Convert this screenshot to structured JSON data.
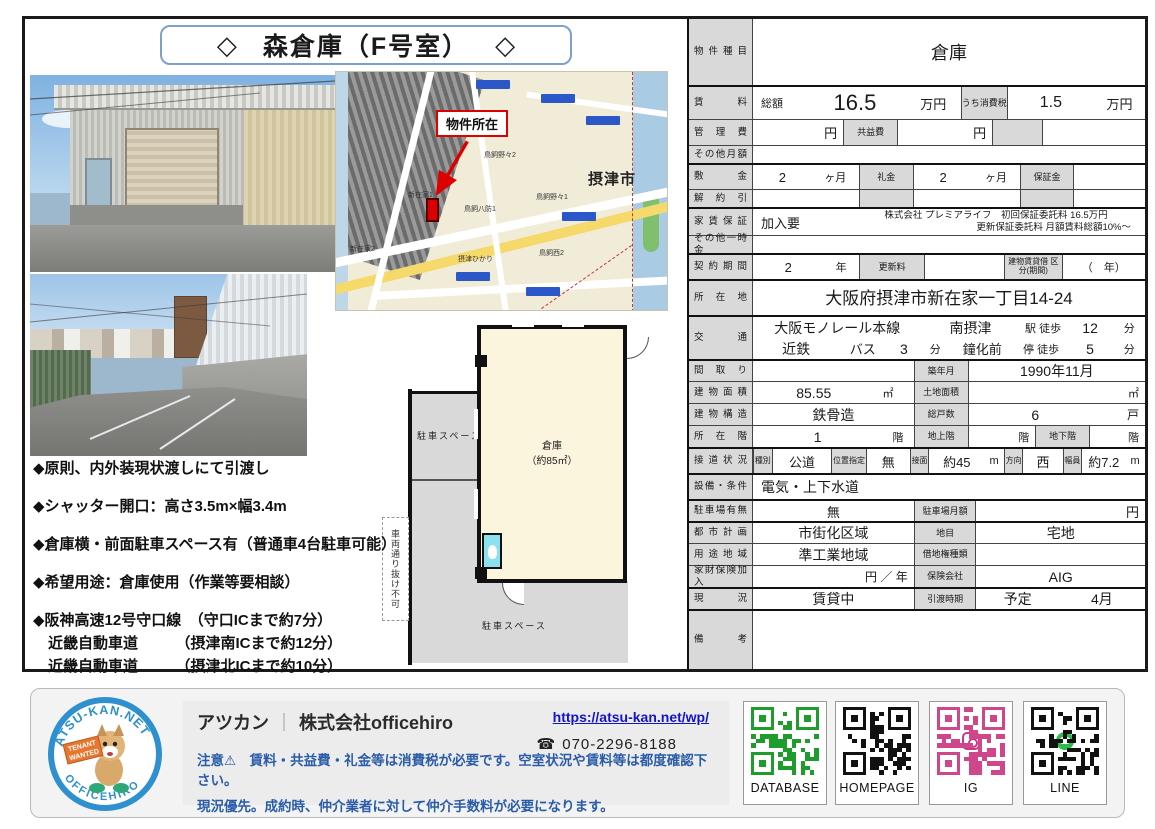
{
  "title": {
    "left": "◇",
    "text": "森倉庫（F号室）",
    "right": "◇"
  },
  "map": {
    "callout": "物件所在",
    "city": "摂津市",
    "labels": [
      "新在家1",
      "新在家2",
      "鳥飼八防1",
      "鳥飼野々2",
      "鳥飼野々1",
      "鳥飼西2",
      "摂津ひかり"
    ]
  },
  "floorplan": {
    "room": "倉庫",
    "area": "（約85㎡）",
    "parking_top": "駐車スペース",
    "parking_bottom": "駐車スペース",
    "no_through": "車両通り抜け不可"
  },
  "bullets": [
    "◆原則、内外装現状渡しにて引渡し",
    "◆シャッター開口：高さ3.5m×幅3.4m",
    "◆倉庫横・前面駐車スペース有（普通車4台駐車可能）",
    "◆希望用途：倉庫使用（作業等要相談）",
    "◆阪神高速12号守口線　（守口ICまで約7分）",
    "　近畿自動車道　　　（摂津南ICまで約12分）",
    "　近畿自動車道　　　（摂津北ICまで約10分）"
  ],
  "property": {
    "type_label": "物件種目",
    "type": "倉庫",
    "rent_label": "賃料",
    "rent_total_label": "総額",
    "rent": "16.5",
    "rent_unit": "万円",
    "tax_label": "うち消費税",
    "tax": "1.5",
    "tax_unit": "万円",
    "mgmt_label": "管理費",
    "mgmt_unit": "円",
    "common_label": "共益費",
    "common_unit": "円",
    "other_monthly_label": "その他月額",
    "deposit_label": "敷金",
    "deposit": "2",
    "deposit_unit": "ヶ月",
    "key_money_label": "礼金",
    "key_money": "2",
    "key_money_unit": "ヶ月",
    "hoshokin_label": "保証金",
    "kaiyaku_label": "解約引",
    "guarantee_label": "家賃保証",
    "guarantee": "加入要",
    "guarantee_note1": "株式会社 プレミアライフ　初回保証委託料 16.5万円",
    "guarantee_note2": "更新保証委託料 月額賃料総額10%～",
    "other_onetime_label": "その他一時金",
    "term_label": "契約期間",
    "term": "2",
    "term_unit": "年",
    "renewal_label": "更新料",
    "lease_type_label": "建物賃貸借 区分(期間)",
    "lease_type_value": "（　年）",
    "address_label": "所在地",
    "address": "大阪府摂津市新在家一丁目14-24",
    "access_label": "交通",
    "access1_line": "大阪モノレール本線",
    "access1_station": "南摂津",
    "access1_walk": "駅 徒歩",
    "access1_min": "12",
    "access1_unit": "分",
    "access2_line": "近鉄",
    "access2_mode": "バス",
    "access2_busmin": "3",
    "access2_busunit": "分",
    "access2_stop": "鐘化前",
    "access2_walk": "停 徒歩",
    "access2_min": "5",
    "access2_unit": "分",
    "madori_label": "間取り",
    "built_label": "築年月",
    "built": "1990年11月",
    "bldg_area_label": "建物面積",
    "bldg_area": "85.55",
    "bldg_area_unit": "㎡",
    "land_area_label": "土地面積",
    "land_area_unit": "㎡",
    "structure_label": "建物構造",
    "structure": "鉄骨造",
    "units_label": "総戸数",
    "units": "6",
    "units_unit": "戸",
    "floor_label": "所在階",
    "floor": "1",
    "floor_unit": "階",
    "above_label": "地上階",
    "above_unit": "階",
    "below_label": "地下階",
    "below_unit": "階",
    "road_label": "接道状況",
    "road_type_label": "種別",
    "road_type": "公道",
    "road_pos_label": "位置指定",
    "road_pos": "無",
    "road_front_label": "接面",
    "road_front": "約45",
    "road_front_unit": "m",
    "road_dir_label": "方向",
    "road_dir": "西",
    "road_width_label": "幅員",
    "road_width": "約7.2",
    "road_width_unit": "m",
    "equip_label": "設備・条件",
    "equip": "電気・上下水道",
    "parking_label": "駐車場有無",
    "parking": "無",
    "parking_fee_label": "駐車場月額",
    "parking_fee_unit": "円",
    "city_plan_label": "都市計画",
    "city_plan": "市街化区域",
    "chimoku_label": "地目",
    "chimoku": "宅地",
    "zoning_label": "用途地域",
    "zoning": "準工業地域",
    "leasehold_label": "借地権種類",
    "insurance_label": "家財保険加入",
    "insurance_unit": "円 ／ 年",
    "insurer_label": "保険会社",
    "insurer": "AIG",
    "status_label": "現況",
    "status": "賃貸中",
    "handover_label": "引渡時期",
    "handover1": "予定",
    "handover2": "4月",
    "remarks_label": "備考"
  },
  "footer": {
    "brand": "アツカン",
    "separator": "｜",
    "company": "株式会社officehiro",
    "url": "https://atsu-kan.net/wp/",
    "phone_icon": "☎",
    "phone": "070-2296-8188",
    "note1": "注意⚠　賃料・共益費・礼金等は消費税が必要です。空室状況や賃料等は都度確認下さい。",
    "note2": "現況優先。成約時、仲介業者に対して仲介手数料が必要になります。",
    "logo_top": "ATSU-KAN.NET",
    "logo_bottom": "OFFICEHIRO",
    "logo_sign1": "TENANT",
    "logo_sign2": "WANTED",
    "qr": [
      {
        "label": "DATABASE",
        "color": "#1f9d2c"
      },
      {
        "label": "HOMEPAGE",
        "color": "#111111"
      },
      {
        "label": "IG",
        "color": "#d0468a"
      },
      {
        "label": "LINE",
        "color": "#111111"
      }
    ],
    "accent_blue": "#2a5ca8",
    "link_blue": "#1414cc",
    "logo_blue": "#2e90ce"
  }
}
